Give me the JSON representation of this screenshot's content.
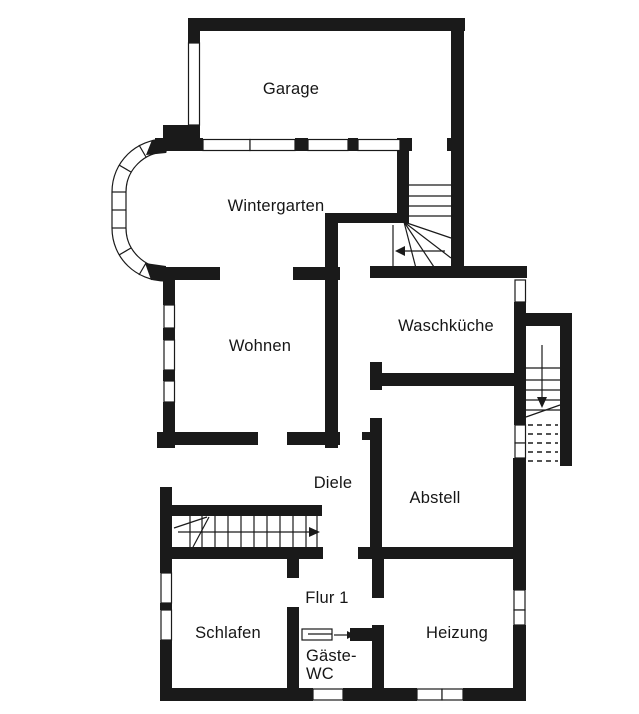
{
  "plan": {
    "type": "floor-plan",
    "language": "de"
  },
  "colors": {
    "wall": "#1a1a1a",
    "background": "#ffffff",
    "window_fill": "#ffffff"
  },
  "rooms": {
    "garage": {
      "label": "Garage"
    },
    "wintergarten": {
      "label": "Wintergarten"
    },
    "wohnen": {
      "label": "Wohnen"
    },
    "waschkueche": {
      "label": "Waschküche"
    },
    "diele": {
      "label": "Diele"
    },
    "abstell": {
      "label": "Abstell"
    },
    "schlafen": {
      "label": "Schlafen"
    },
    "flur1": {
      "label": "Flur 1"
    },
    "gaeste_wc": {
      "line1": "Gäste-",
      "line2": "WC"
    },
    "heizung": {
      "label": "Heizung"
    }
  },
  "icons": {
    "stair_upper_arrow": "arrow-left",
    "stair_lower_arrow": "arrow-right",
    "stair_exterior_arrow": "arrow-down",
    "door_gaeste_wc_arrow": "arrow-right"
  }
}
